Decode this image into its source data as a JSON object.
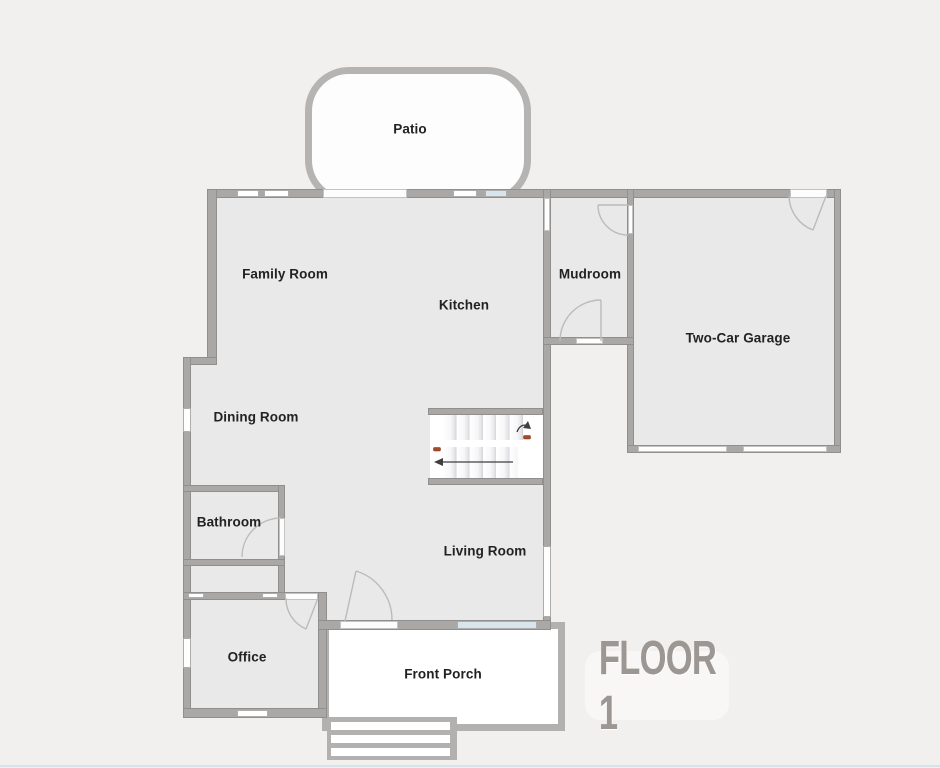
{
  "plan": {
    "floor_label": "FLOOR 1",
    "rooms": [
      {
        "id": "patio",
        "label": "Patio"
      },
      {
        "id": "family-room",
        "label": "Family Room"
      },
      {
        "id": "kitchen",
        "label": "Kitchen"
      },
      {
        "id": "mudroom",
        "label": "Mudroom"
      },
      {
        "id": "two-car-garage",
        "label": "Two-Car Garage"
      },
      {
        "id": "dining-room",
        "label": "Dining Room"
      },
      {
        "id": "bathroom",
        "label": "Bathroom"
      },
      {
        "id": "office",
        "label": "Office"
      },
      {
        "id": "living-room",
        "label": "Living Room"
      },
      {
        "id": "front-porch",
        "label": "Front Porch"
      }
    ],
    "features": [
      "staircase-up-and-down-with-arrows",
      "front-entry-steps",
      "door-swing-arcs",
      "windows"
    ],
    "colors": {
      "page_bg": "#f2f0ee",
      "room_fill": "#e9e9ea",
      "wall": "#a9a8a7",
      "wall_edge": "#908f8e",
      "outdoor_outline": "#b5b4b3",
      "window_glass": "#d9e5ec",
      "floor_label_text": "#9c9792",
      "floor_label_bg": "#f8f7f5",
      "stair_marker_red": "#a34b2d",
      "arrow": "#3f3f3f"
    }
  }
}
